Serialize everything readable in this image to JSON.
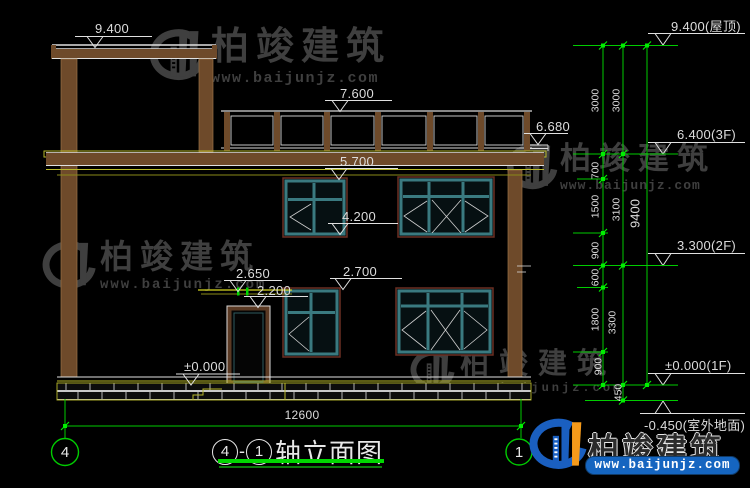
{
  "drawing": {
    "building_levels": [
      "9.400",
      "7.600",
      "6.680",
      "5.700",
      "4.200",
      "2.650",
      "2.200",
      "2.700",
      "±0.000"
    ],
    "grid_levels": [
      "9.400(屋顶)",
      "6.400(3F)",
      "3.300(2F)",
      "±0.000(1F)",
      "-0.450(室外地面)"
    ],
    "chain_inner": [
      "3000",
      "700",
      "1500",
      "900",
      "600",
      "1800",
      "900"
    ],
    "chain_mid": [
      "3000",
      "3100",
      "3300",
      "450"
    ],
    "total_height": "9400",
    "total_width": "12600",
    "axis_left": "4",
    "axis_right": "1",
    "title": {
      "start_axis": "4",
      "dash": "-",
      "end_axis": "1",
      "name": "轴立面图"
    }
  },
  "watermark": {
    "brand": "柏竣建筑",
    "url": "www.baijunjz.com"
  },
  "logo": {
    "brand": "柏竣建筑",
    "url": "www.baijunjz.com"
  },
  "colors": {
    "background": "#000000",
    "dimension_green": "#00cc00",
    "line_white": "#e0e0e0",
    "wood_brown": "#6e4a2a",
    "accent_yellow": "#b9b92a",
    "window_teal": "#3a7a80",
    "watermark_gray": "#3f3f3f",
    "logo_blue": "#1a5fc0",
    "logo_orange": "#f59a1a"
  }
}
